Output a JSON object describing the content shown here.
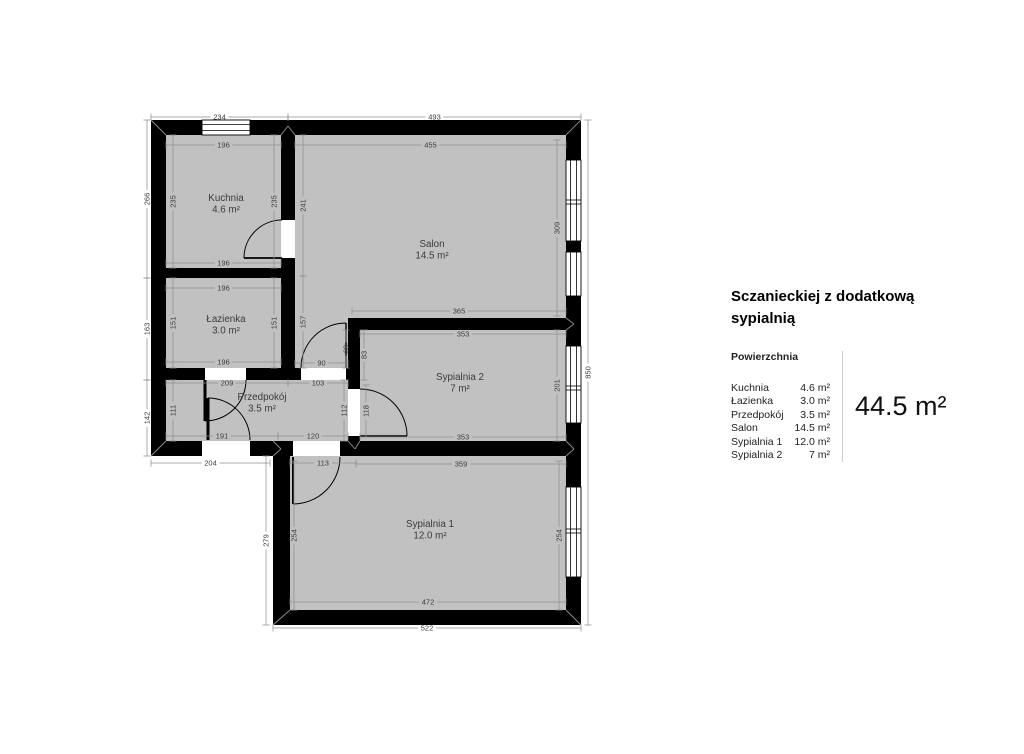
{
  "panel": {
    "title_line1": "Sczanieckiej z dodatkową",
    "title_line2": "sypialnią",
    "section_label": "Powierzchnia",
    "rows": [
      {
        "name": "Kuchnia",
        "area": "4.6 m²"
      },
      {
        "name": "Łazienka",
        "area": "3.0 m²"
      },
      {
        "name": "Przedpokój",
        "area": "3.5 m²"
      },
      {
        "name": "Salon",
        "area": "14.5 m²"
      },
      {
        "name": "Sypialnia 1",
        "area": "12.0 m²"
      },
      {
        "name": "Sypialnia 2",
        "area": "7 m²"
      }
    ],
    "total": "44.5 m²"
  },
  "plan": {
    "colors": {
      "wall": "#000000",
      "room": "#c1c1c1",
      "window_fill": "#ffffff",
      "window_frame": "#000000",
      "dim_line": "#8f8f8f",
      "dim_text": "#3b3b3b",
      "label_text": "#3b3b3b",
      "miter": "#8f8f8f"
    },
    "floor_rects": [
      [
        158,
        128,
        416,
        321
      ],
      [
        280,
        449,
        294,
        169
      ]
    ],
    "walls": [
      [
        151,
        120,
        430,
        15
      ],
      [
        151,
        135,
        15,
        321
      ],
      [
        566,
        120,
        15,
        505
      ],
      [
        151,
        441,
        430,
        15
      ],
      [
        273,
        456,
        17,
        169
      ],
      [
        273,
        610,
        308,
        15
      ],
      [
        281,
        135,
        14,
        143
      ],
      [
        151,
        268,
        144,
        10
      ],
      [
        151,
        368,
        209,
        12
      ],
      [
        281,
        278,
        14,
        90
      ],
      [
        348,
        318,
        12,
        123
      ],
      [
        348,
        318,
        233,
        12
      ]
    ],
    "openings": [
      [
        281,
        220,
        14,
        38
      ],
      [
        205,
        368,
        41,
        12
      ],
      [
        301,
        368,
        45,
        12
      ],
      [
        348,
        389,
        12,
        47
      ],
      [
        202,
        441,
        48,
        15
      ],
      [
        293,
        441,
        47,
        15
      ]
    ],
    "windows": [
      {
        "x": 202,
        "y": 120,
        "w": 48,
        "h": 15,
        "o": "h",
        "div": []
      },
      {
        "x": 566,
        "y": 160,
        "w": 15,
        "h": 81,
        "o": "v",
        "div": [
          202
        ]
      },
      {
        "x": 566,
        "y": 252,
        "w": 15,
        "h": 44,
        "o": "v",
        "div": []
      },
      {
        "x": 566,
        "y": 346,
        "w": 15,
        "h": 77,
        "o": "v",
        "div": [
          388
        ]
      },
      {
        "x": 566,
        "y": 487,
        "w": 15,
        "h": 90,
        "o": "v",
        "div": [
          531
        ]
      }
    ],
    "doors": [
      {
        "arc": [
          244,
          258,
          38,
          282,
          220,
          1
        ],
        "leaf": [
          282,
          258,
          244,
          258,
          1.8
        ]
      },
      {
        "arc": [
          205,
          421,
          41,
          246,
          380,
          0
        ],
        "leaf": [
          205,
          380,
          205,
          421,
          3
        ]
      },
      {
        "arc": [
          301,
          368,
          45,
          346,
          323,
          1
        ],
        "leaf": [
          346,
          368,
          346,
          323,
          1.4
        ]
      },
      {
        "arc": [
          360,
          389,
          47,
          407,
          436,
          1
        ],
        "leaf": [
          360,
          436,
          407,
          436,
          1.4
        ]
      },
      {
        "arc": [
          340,
          457,
          47,
          293,
          504,
          1
        ],
        "leaf": [
          293,
          457,
          293,
          504,
          2
        ]
      },
      {
        "arc": [
          208,
          398,
          42,
          250,
          440,
          1
        ],
        "leaf": [
          208,
          398,
          208,
          440,
          3
        ]
      }
    ],
    "miters": [
      [
        151,
        120,
        166,
        135
      ],
      [
        581,
        120,
        566,
        135
      ],
      [
        581,
        625,
        566,
        610
      ],
      [
        273,
        625,
        290,
        610
      ],
      [
        151,
        456,
        166,
        441
      ],
      [
        281,
        135,
        288,
        126
      ],
      [
        288,
        126,
        295,
        135
      ],
      [
        566,
        318,
        574,
        324
      ],
      [
        566,
        330,
        574,
        324
      ],
      [
        566,
        441,
        574,
        449
      ],
      [
        566,
        456,
        574,
        449
      ],
      [
        273,
        441,
        281,
        449
      ],
      [
        273,
        456,
        281,
        449
      ],
      [
        348,
        441,
        355,
        449
      ],
      [
        360,
        441,
        355,
        449
      ]
    ],
    "dims": [
      [
        "234",
        151,
        117,
        288,
        117,
        0
      ],
      [
        "493",
        288,
        117,
        581,
        117,
        0
      ],
      [
        "196",
        166,
        145,
        281,
        145,
        0
      ],
      [
        "455",
        295,
        145,
        566,
        145,
        0
      ],
      [
        "196",
        166,
        263,
        281,
        263,
        0
      ],
      [
        "196",
        166,
        288,
        281,
        288,
        0
      ],
      [
        "196",
        166,
        362,
        281,
        362,
        0
      ],
      [
        "365",
        352,
        311,
        566,
        311,
        0
      ],
      [
        "353",
        360,
        334,
        566,
        334,
        0
      ],
      [
        "90",
        295,
        363,
        348,
        363,
        0
      ],
      [
        "209",
        166,
        383,
        288,
        383,
        0
      ],
      [
        "103",
        288,
        383,
        348,
        383,
        0
      ],
      [
        "191",
        166,
        436,
        278,
        436,
        0
      ],
      [
        "120",
        278,
        436,
        348,
        436,
        0
      ],
      [
        "353",
        360,
        437,
        566,
        437,
        0
      ],
      [
        "204",
        151,
        463,
        270,
        463,
        0
      ],
      [
        "113",
        290,
        463,
        356,
        463,
        0
      ],
      [
        "359",
        356,
        464,
        566,
        464,
        0
      ],
      [
        "472",
        290,
        602,
        566,
        602,
        0
      ],
      [
        "522",
        273,
        628,
        581,
        628,
        0
      ],
      [
        "266",
        147,
        120,
        147,
        278,
        1
      ],
      [
        "163",
        147,
        278,
        147,
        380,
        1
      ],
      [
        "142",
        147,
        380,
        147,
        456,
        1
      ],
      [
        "235",
        173,
        135,
        173,
        268,
        1
      ],
      [
        "151",
        173,
        278,
        173,
        368,
        1
      ],
      [
        "111",
        173,
        380,
        173,
        441,
        1
      ],
      [
        "235",
        274,
        135,
        274,
        268,
        1
      ],
      [
        "151",
        274,
        278,
        274,
        368,
        1
      ],
      [
        "241",
        303,
        135,
        303,
        276,
        1
      ],
      [
        "157",
        303,
        276,
        303,
        368,
        1
      ],
      [
        "309",
        557,
        140,
        557,
        316,
        1
      ],
      [
        "69",
        346,
        330,
        346,
        368,
        1
      ],
      [
        "83",
        364,
        330,
        364,
        380,
        1
      ],
      [
        "201",
        557,
        330,
        557,
        441,
        1
      ],
      [
        "850",
        588,
        120,
        588,
        625,
        1
      ],
      [
        "112",
        344,
        380,
        344,
        441,
        1
      ],
      [
        "118",
        366,
        385,
        366,
        437,
        1
      ],
      [
        "254",
        294,
        461,
        294,
        610,
        1
      ],
      [
        "254",
        559,
        461,
        559,
        610,
        1
      ],
      [
        "279",
        266,
        456,
        266,
        625,
        1
      ]
    ],
    "rooms": [
      {
        "x": 226,
        "y": 201,
        "name": "Kuchnia",
        "area": "4.6 m²"
      },
      {
        "x": 432,
        "y": 247,
        "name": "Salon",
        "area": "14.5 m²"
      },
      {
        "x": 226,
        "y": 322,
        "name": "Łazienka",
        "area": "3.0 m²"
      },
      {
        "x": 262,
        "y": 400,
        "name": "Przedpokój",
        "area": "3.5 m²"
      },
      {
        "x": 460,
        "y": 380,
        "name": "Sypialnia 2",
        "area": "7 m²"
      },
      {
        "x": 430,
        "y": 527,
        "name": "Sypialnia 1",
        "area": "12.0 m²"
      }
    ]
  }
}
